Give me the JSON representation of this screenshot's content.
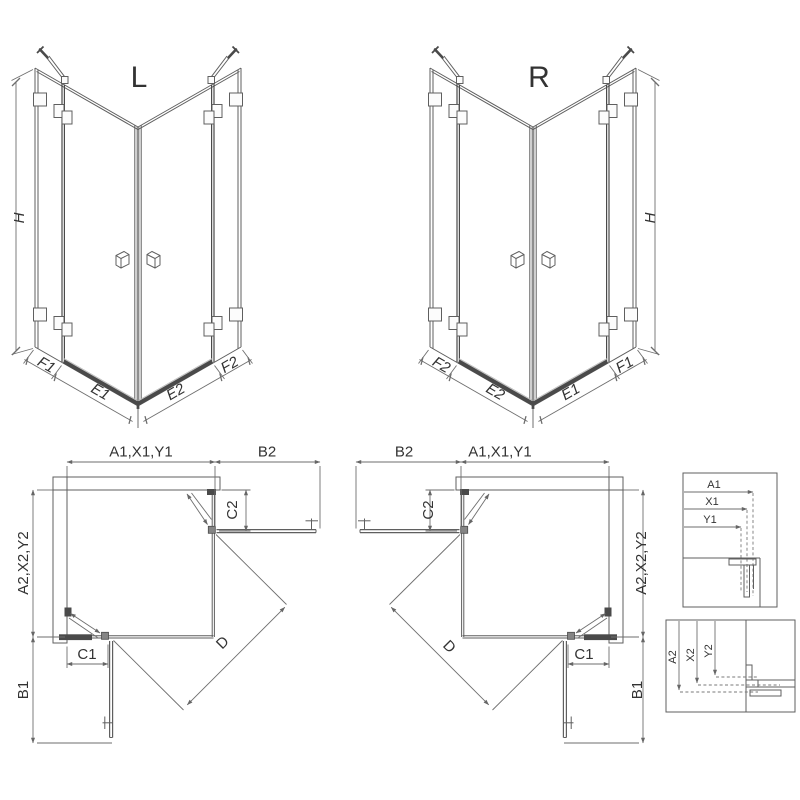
{
  "drawing": {
    "iso_left": {
      "label": "L",
      "height": "H",
      "widths": [
        "F1",
        "E1",
        "E2",
        "F2"
      ]
    },
    "iso_right": {
      "label": "R",
      "height": "H",
      "widths": [
        "F2",
        "E2",
        "E1",
        "F1"
      ]
    },
    "plan_left": {
      "top": "A1,X1,Y1",
      "top_right": "B2",
      "left": "A2,X2,Y2",
      "bottom_left": "B1",
      "c_top": "C2",
      "c_bottom": "C1",
      "diagonal": "D"
    },
    "plan_right": {
      "top": "A1,X1,Y1",
      "top_left": "B2",
      "right": "A2,X2,Y2",
      "bottom_right": "B1",
      "c_left": "C2",
      "c_bottom": "C1",
      "diagonal": "D"
    },
    "detail_top": {
      "rows": [
        "A1",
        "X1",
        "Y1"
      ]
    },
    "detail_bottom": {
      "rows": [
        "A2",
        "X2",
        "Y2"
      ]
    }
  },
  "colors": {
    "background": "#ffffff",
    "line": "#5f5f5f",
    "dim": "#6e6e6e",
    "dark": "#4a4a4a",
    "hatch": "#9a9a9a",
    "text": "#333333"
  }
}
